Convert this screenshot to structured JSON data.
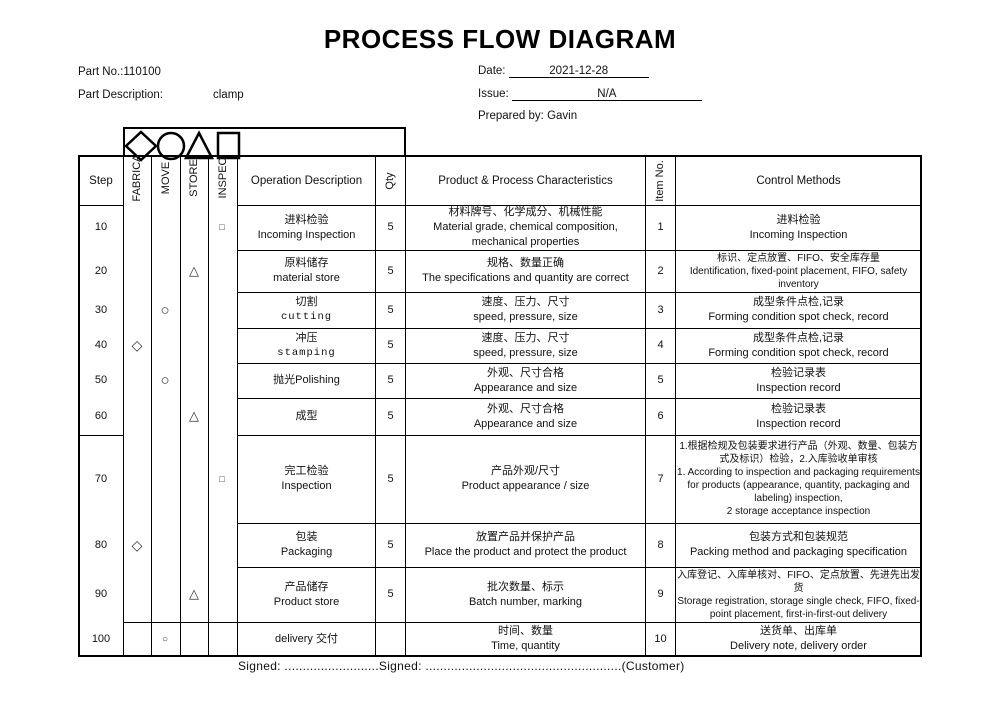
{
  "title": "PROCESS FLOW DIAGRAM",
  "info": {
    "part_no_label": "Part No.:110100",
    "part_desc_label": "Part Description:",
    "part_desc_value": "clamp",
    "date_label": "Date:",
    "date_value": "2021-12-28",
    "issue_label": "Issue:",
    "issue_value": "N/A",
    "prepared_label": "Prepared by:",
    "prepared_value": "Gavin"
  },
  "legend_icons": [
    "diamond-icon",
    "circle-icon",
    "triangle-icon",
    "square-icon"
  ],
  "table": {
    "headers": {
      "step": "Step",
      "fabricate": "FABRICA",
      "move": "MOVE",
      "store": "STORE",
      "inspect": "INSPEC",
      "operation": "Operation Description",
      "qty": "Qty",
      "characteristics": "Product & Process Characteristics",
      "item_no": "Item No.",
      "control": "Control Methods"
    },
    "rows": [
      {
        "step": "10",
        "symbol": "square-small",
        "symbol_column": "INSPEC",
        "symbol_glyph": "□",
        "op_cn": "进料检验",
        "op_en": "Incoming Inspection",
        "qty": "5",
        "char_cn": "材料牌号、化学成分、机械性能",
        "char_en": "Material grade, chemical composition, mechanical properties",
        "item": "1",
        "ctrl_cn": "进料检验",
        "ctrl_en": "Incoming Inspection"
      },
      {
        "step": "20",
        "symbol": "triangle",
        "symbol_column": "STORE",
        "symbol_glyph": "△",
        "op_cn": "原料储存",
        "op_en": "material store",
        "qty": "5",
        "char_cn": "规格、数量正确",
        "char_en": "The specifications and quantity are correct",
        "item": "2",
        "ctrl_cn": "标识、定点放置、FIFO、安全库存量",
        "ctrl_en": "Identification, fixed-point placement, FIFO, safety inventory"
      },
      {
        "step": "30",
        "symbol": "circle",
        "symbol_column": "MOVE",
        "symbol_glyph": "○",
        "op_cn": "切割",
        "op_en": "cutting",
        "qty": "5",
        "char_cn": "速度、压力、尺寸",
        "char_en": "speed, pressure, size",
        "item": "3",
        "ctrl_cn": "成型条件点检,记录",
        "ctrl_en": "Forming condition spot check, record"
      },
      {
        "step": "40",
        "symbol": "diamond",
        "symbol_column": "FABRICA",
        "symbol_glyph": "◇",
        "op_cn": "冲压",
        "op_en": "stamping",
        "qty": "5",
        "char_cn": "速度、压力、尺寸",
        "char_en": "speed, pressure, size",
        "item": "4",
        "ctrl_cn": "成型条件点检,记录",
        "ctrl_en": "Forming condition spot check, record"
      },
      {
        "step": "50",
        "symbol": "circle",
        "symbol_column": "MOVE",
        "symbol_glyph": "○",
        "op_cn": "抛光Polishing",
        "op_en": "",
        "qty": "5",
        "char_cn": "外观、尺寸合格",
        "char_en": "Appearance and size",
        "item": "5",
        "ctrl_cn": "检验记录表",
        "ctrl_en": "Inspection record"
      },
      {
        "step": "60",
        "symbol": "triangle",
        "symbol_column": "STORE",
        "symbol_glyph": "△",
        "op_cn": "成型",
        "op_en": "",
        "qty": "5",
        "char_cn": "外观、尺寸合格",
        "char_en": "Appearance and size",
        "item": "6",
        "ctrl_cn": "检验记录表",
        "ctrl_en": "Inspection record"
      },
      {
        "step": "70",
        "symbol": "square-small",
        "symbol_column": "INSPEC",
        "symbol_glyph": "□",
        "op_cn": "完工检验",
        "op_en": "Inspection",
        "qty": "5",
        "char_cn": "产品外观/尺寸",
        "char_en": "Product appearance / size",
        "item": "7",
        "ctrl_cn": "1.根据检规及包装要求进行产品（外观、数量、包装方式及标识）检验，2.入库验收单审核",
        "ctrl_en": "1. According to inspection and packaging requirements for products (appearance, quantity, packaging and labeling) inspection,\n2 storage acceptance inspection"
      },
      {
        "step": "80",
        "symbol": "diamond",
        "symbol_column": "FABRICA",
        "symbol_glyph": "◇",
        "op_cn": "包装",
        "op_en": "Packaging",
        "qty": "5",
        "char_cn": "放置产品并保护产品",
        "char_en": "Place the product and protect the product",
        "item": "8",
        "ctrl_cn": "包装方式和包装规范",
        "ctrl_en": "Packing method and packaging specification"
      },
      {
        "step": "90",
        "symbol": "triangle",
        "symbol_column": "STORE",
        "symbol_glyph": "△",
        "op_cn": "产品储存",
        "op_en": "Product store",
        "qty": "5",
        "char_cn": "批次数量、标示",
        "char_en": "Batch number, marking",
        "item": "9",
        "ctrl_cn": "入库登记、入库单核对、FIFO、定点放置、先进先出发货",
        "ctrl_en": "Storage registration, storage single check, FIFO, fixed-point placement, first-in-first-out delivery"
      },
      {
        "step": "100",
        "symbol": "circle-small",
        "symbol_column": "MOVE",
        "symbol_glyph": "○",
        "op_cn": "delivery  交付",
        "op_en": "",
        "qty": "",
        "char_cn": "时间、数量",
        "char_en": "Time, quantity",
        "item": "10",
        "ctrl_cn": "送货单、出库单",
        "ctrl_en": "Delivery note, delivery order"
      }
    ]
  },
  "footer": {
    "signed_line": "Signed: ..........................Signed: ......................................................(Customer)"
  }
}
